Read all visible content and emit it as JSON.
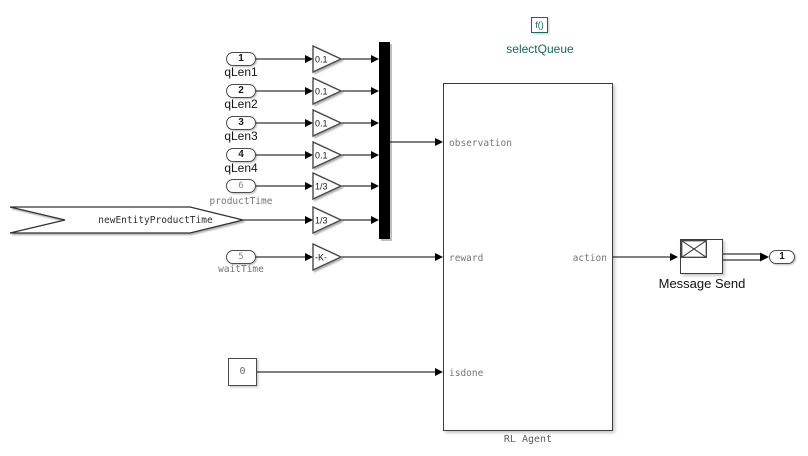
{
  "diagram": {
    "sources": [
      {
        "port": "1",
        "label": "qLen1"
      },
      {
        "port": "2",
        "label": "qLen2"
      },
      {
        "port": "3",
        "label": "qLen3"
      },
      {
        "port": "4",
        "label": "qLen4"
      },
      {
        "port": "6",
        "label": "productTime"
      },
      {
        "port": "5",
        "label": "waitTime"
      }
    ],
    "gains": [
      "0.1",
      "0.1",
      "0.1",
      "0.1",
      "1/3",
      "1/3",
      "-K-"
    ],
    "annotation_arrow": {
      "label": "newEntityProductTime"
    },
    "constant": {
      "value": "0"
    },
    "rl_agent": {
      "label": "RL Agent",
      "input_ports": [
        "observation",
        "reward",
        "isdone"
      ],
      "output_port": "action"
    },
    "simulink_function": {
      "glyph": "f()",
      "label": "selectQueue",
      "accent_color": "#17695c"
    },
    "message_send": {
      "label": "Message Send"
    },
    "out_port": {
      "port": "1"
    }
  }
}
